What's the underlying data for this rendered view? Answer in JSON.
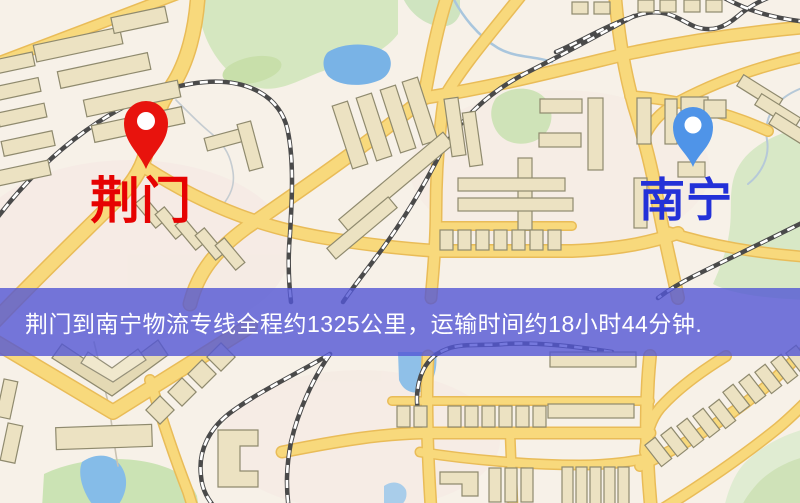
{
  "window": {
    "width": 800,
    "height": 503
  },
  "map": {
    "origin_marker": {
      "label": "荆门",
      "pin_color": "#e8130d",
      "label_color": "#e60202"
    },
    "destination_marker": {
      "label": "南宁",
      "pin_color": "#4f94e8",
      "label_color": "#2331d8"
    }
  },
  "banner": {
    "text": "荆门到南宁物流专线全程约1325公里，运输时间约18小时44分钟.",
    "background_color": "#5256d5",
    "text_color": "#ffffff"
  },
  "route": {
    "from": "荆门",
    "to": "南宁",
    "distance_km": 1325,
    "duration_hours": 18,
    "duration_minutes": 44
  },
  "palette": {
    "map_background": "#f7f1e8",
    "road": "#f8d97c",
    "road_casing": "#e9bc58",
    "railway": "#4a4a4a",
    "park": "#d5e7c0",
    "water": "#7fb6e6",
    "building": "#ece2c2"
  }
}
